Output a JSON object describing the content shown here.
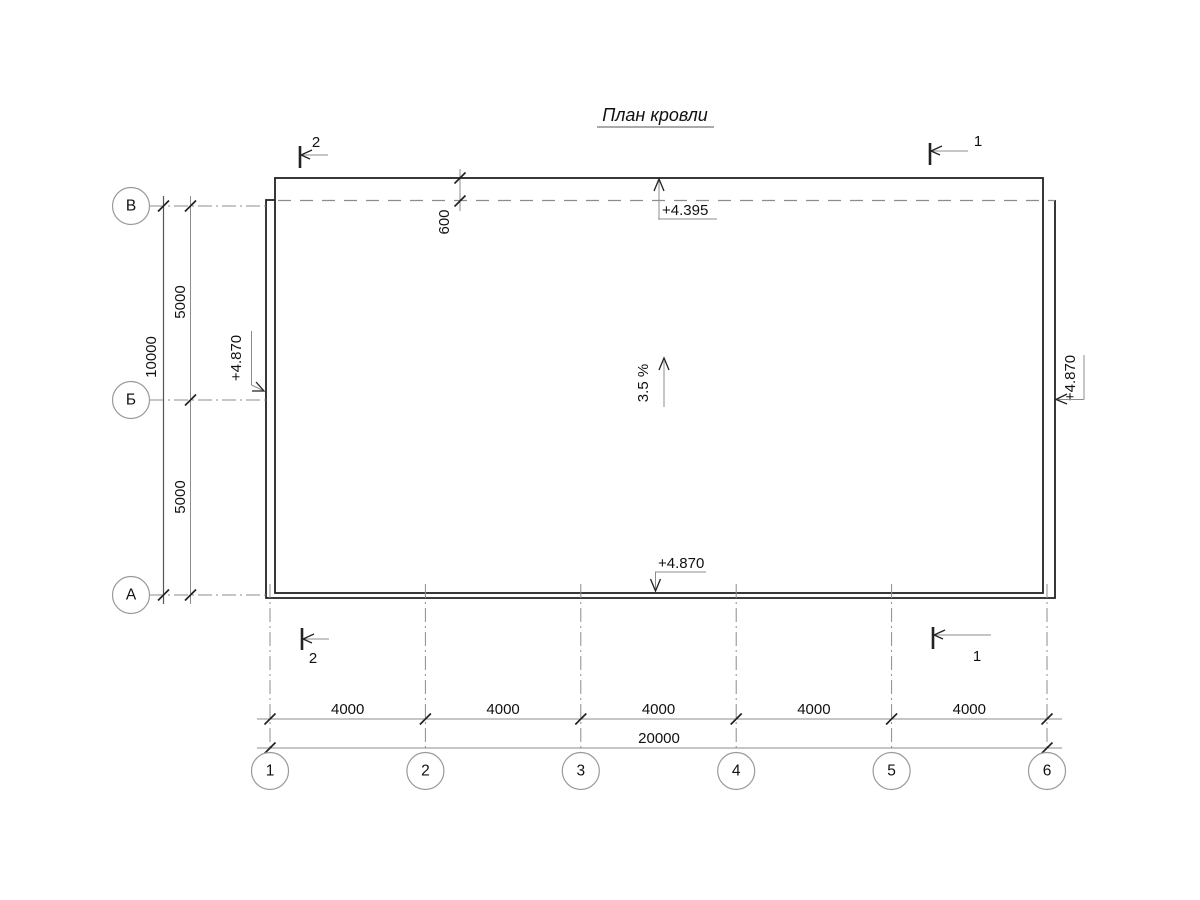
{
  "title": "План кровли",
  "row_axes": [
    {
      "label": "В"
    },
    {
      "label": "Б"
    },
    {
      "label": "А"
    }
  ],
  "col_axes": [
    {
      "label": "1"
    },
    {
      "label": "2"
    },
    {
      "label": "3"
    },
    {
      "label": "4"
    },
    {
      "label": "5"
    },
    {
      "label": "6"
    }
  ],
  "dimensions": {
    "row_spans": [
      "5000",
      "5000"
    ],
    "row_total": "10000",
    "roof_overhang": "600",
    "col_spans": [
      "4000",
      "4000",
      "4000",
      "4000",
      "4000"
    ],
    "col_total": "20000"
  },
  "elevations": {
    "top": "+4.395",
    "bottom": "+4.870",
    "left": "+4.870",
    "right": "+4.870"
  },
  "slope_label": "3.5 %",
  "section_marks": {
    "section_1": "1",
    "section_2": "2"
  },
  "colors": {
    "main_line": "#222222",
    "dim_line": "#8c8c8c",
    "text": "#111111",
    "background": "#ffffff"
  }
}
